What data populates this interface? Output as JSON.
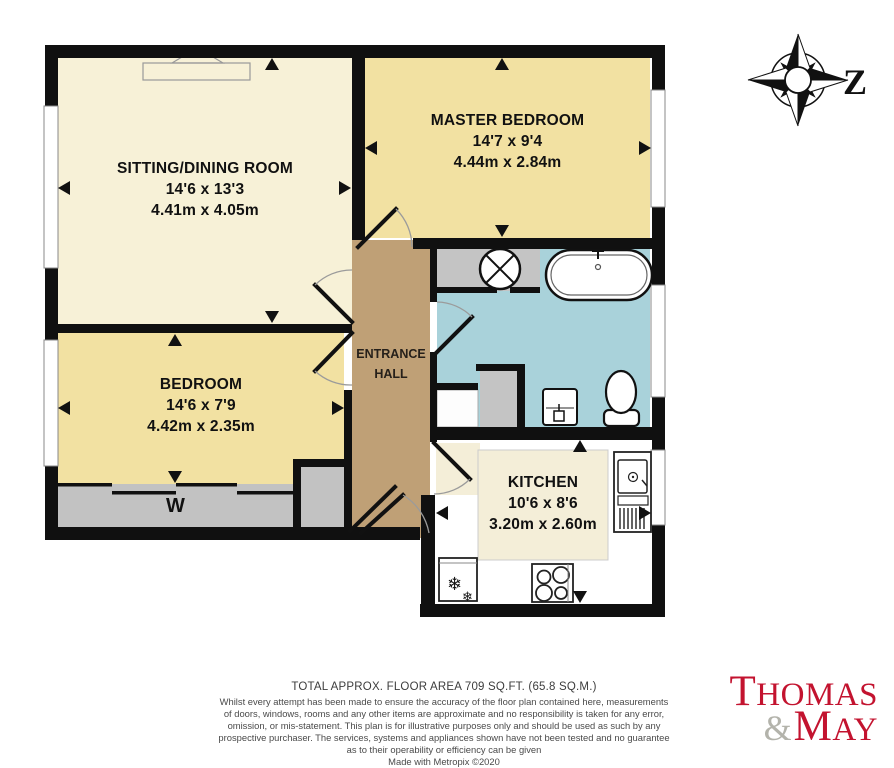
{
  "plan": {
    "rooms": {
      "sitting": {
        "name": "SITTING/DINING ROOM",
        "imperial": "14'6 x 13'3",
        "metric": "4.41m x 4.05m"
      },
      "master": {
        "name": "MASTER BEDROOM",
        "imperial": "14'7 x 9'4",
        "metric": "4.44m x 2.84m"
      },
      "bedroom": {
        "name": "BEDROOM",
        "imperial": "14'6 x 7'9",
        "metric": "4.42m x 2.35m"
      },
      "kitchen": {
        "name": "KITCHEN",
        "imperial": "10'6 x 8'6",
        "metric": "3.20m x 2.60m"
      },
      "hall": {
        "line1": "ENTRANCE",
        "line2": "HALL"
      }
    },
    "labels": {
      "wardrobe": "W"
    },
    "compass": {
      "letter": "Z"
    },
    "icons": {
      "fridge_glyph": "❄"
    },
    "colors": {
      "wall": "#101010",
      "cream": "#f7f1d7",
      "yellow": "#f2e1a2",
      "hall_brown": "#bfa076",
      "bath_blue": "#a9d2da",
      "gray": "#c2c2c2",
      "logo_red": "#c3132f",
      "logo_gray": "#b3b3ab"
    }
  },
  "footer": {
    "total_area": "TOTAL APPROX. FLOOR AREA 709 SQ.FT. (65.8 SQ.M.)",
    "disclaimer": "Whilst every attempt has been made to ensure the accuracy of the floor plan contained here, measurements of doors, windows, rooms and any other items are approximate and no responsibility is taken for any error, omission, or mis-statement. This plan is for illustrative purposes only and should be used as such by any prospective purchaser. The services, systems and appliances shown have not been tested and no guarantee as to their operability or efficiency can be given",
    "credit": "Made with Metropix ©2020"
  },
  "logo": {
    "word1": "THOMAS",
    "amp": "&",
    "word2": "MAY"
  }
}
